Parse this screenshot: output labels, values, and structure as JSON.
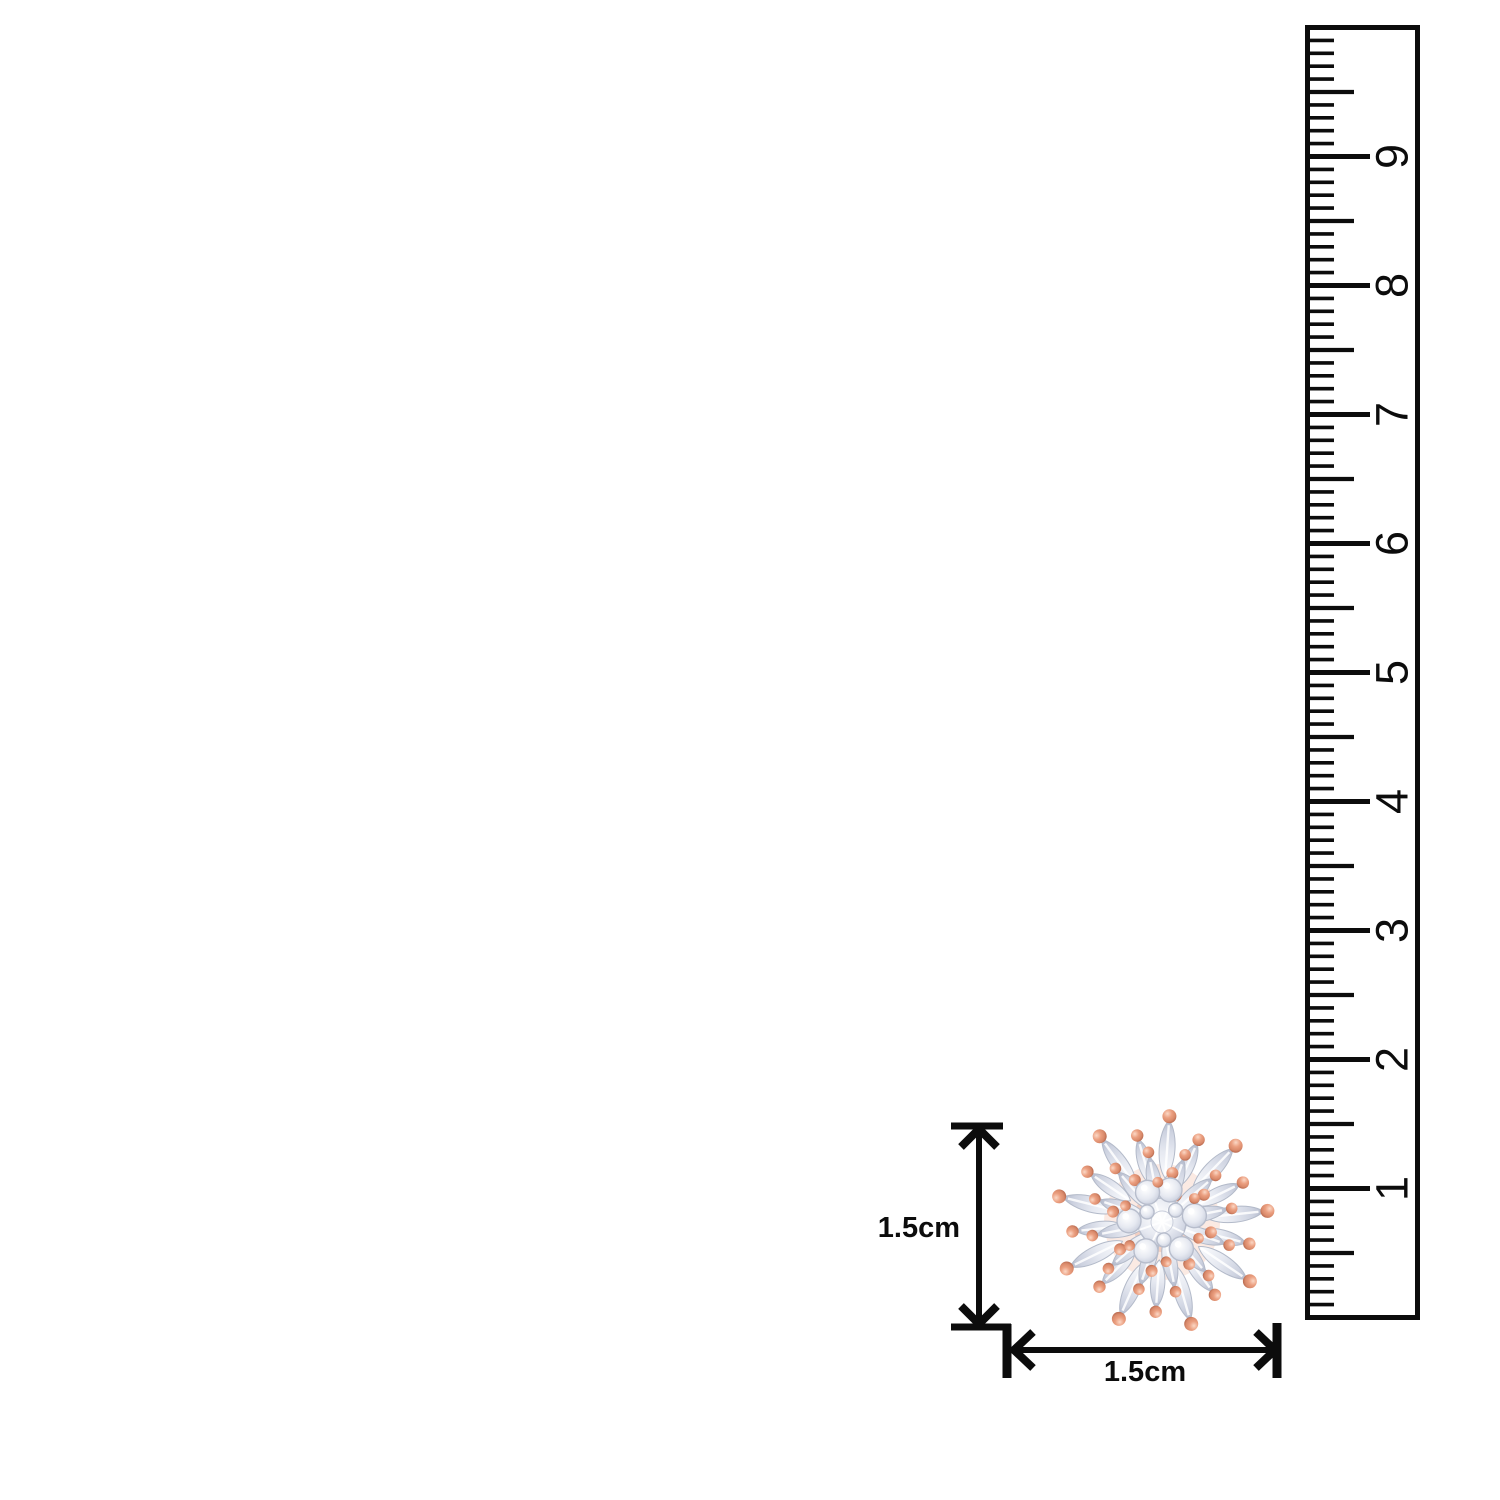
{
  "image": {
    "background": "#ffffff",
    "ink": "#0c0c0c",
    "subject": "rose-gold crystal flower stud earring size guide"
  },
  "ruler": {
    "numbers": [
      "1",
      "2",
      "3",
      "4",
      "5",
      "6",
      "7",
      "8",
      "9"
    ]
  },
  "size_labels": {
    "height": "1.5cm",
    "width": "1.5cm"
  },
  "jewelry": {
    "colors": {
      "rose_gold_light": "#fbd8c6",
      "rose_gold": "#eb9f80",
      "rose_gold_mid": "#d98a6b",
      "rose_gold_dark": "#b4664c",
      "crystal_white": "#fbfcfe",
      "crystal_light": "#e6e9f1",
      "crystal_mid": "#cdd2e0",
      "crystal_dark": "#b2b8ca",
      "petal_stroke": "#b3bac9"
    }
  }
}
